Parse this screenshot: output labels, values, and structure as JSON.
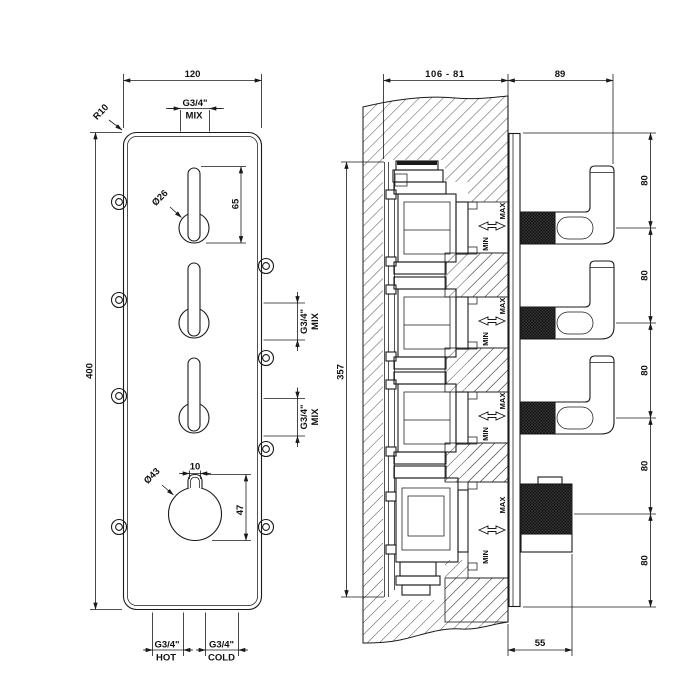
{
  "front": {
    "dim_width": "120",
    "dim_height": "400",
    "radius_label": "R10",
    "top_port_size": "G3/4\"",
    "top_port_name": "MIX",
    "lever_dia": "Ø26",
    "dim_lever_len": "65",
    "side_ports": [
      {
        "size": "G3/4\"",
        "name": "MIX"
      },
      {
        "size": "G3/4\"",
        "name": "MIX"
      }
    ],
    "dim_nub": "10",
    "knob_dia": "Ø43",
    "dim_knob": "47",
    "hot_size": "G3/4\"",
    "hot_name": "HOT",
    "cold_size": "G3/4\"",
    "cold_name": "COLD"
  },
  "side": {
    "dim_depth_range": "106 - 81",
    "dim_external": "89",
    "dim_body_height": "357",
    "dim_spacing": [
      "80",
      "80",
      "80",
      "80",
      "80"
    ],
    "dim_knob_depth": "55",
    "max_labels": [
      "MAX",
      "MAX",
      "MAX",
      "MAX"
    ],
    "min_labels": [
      "MIN",
      "MIN",
      "MIN",
      "MIN"
    ]
  },
  "colors": {
    "line": "#1a1a1a",
    "background": "#ffffff"
  }
}
